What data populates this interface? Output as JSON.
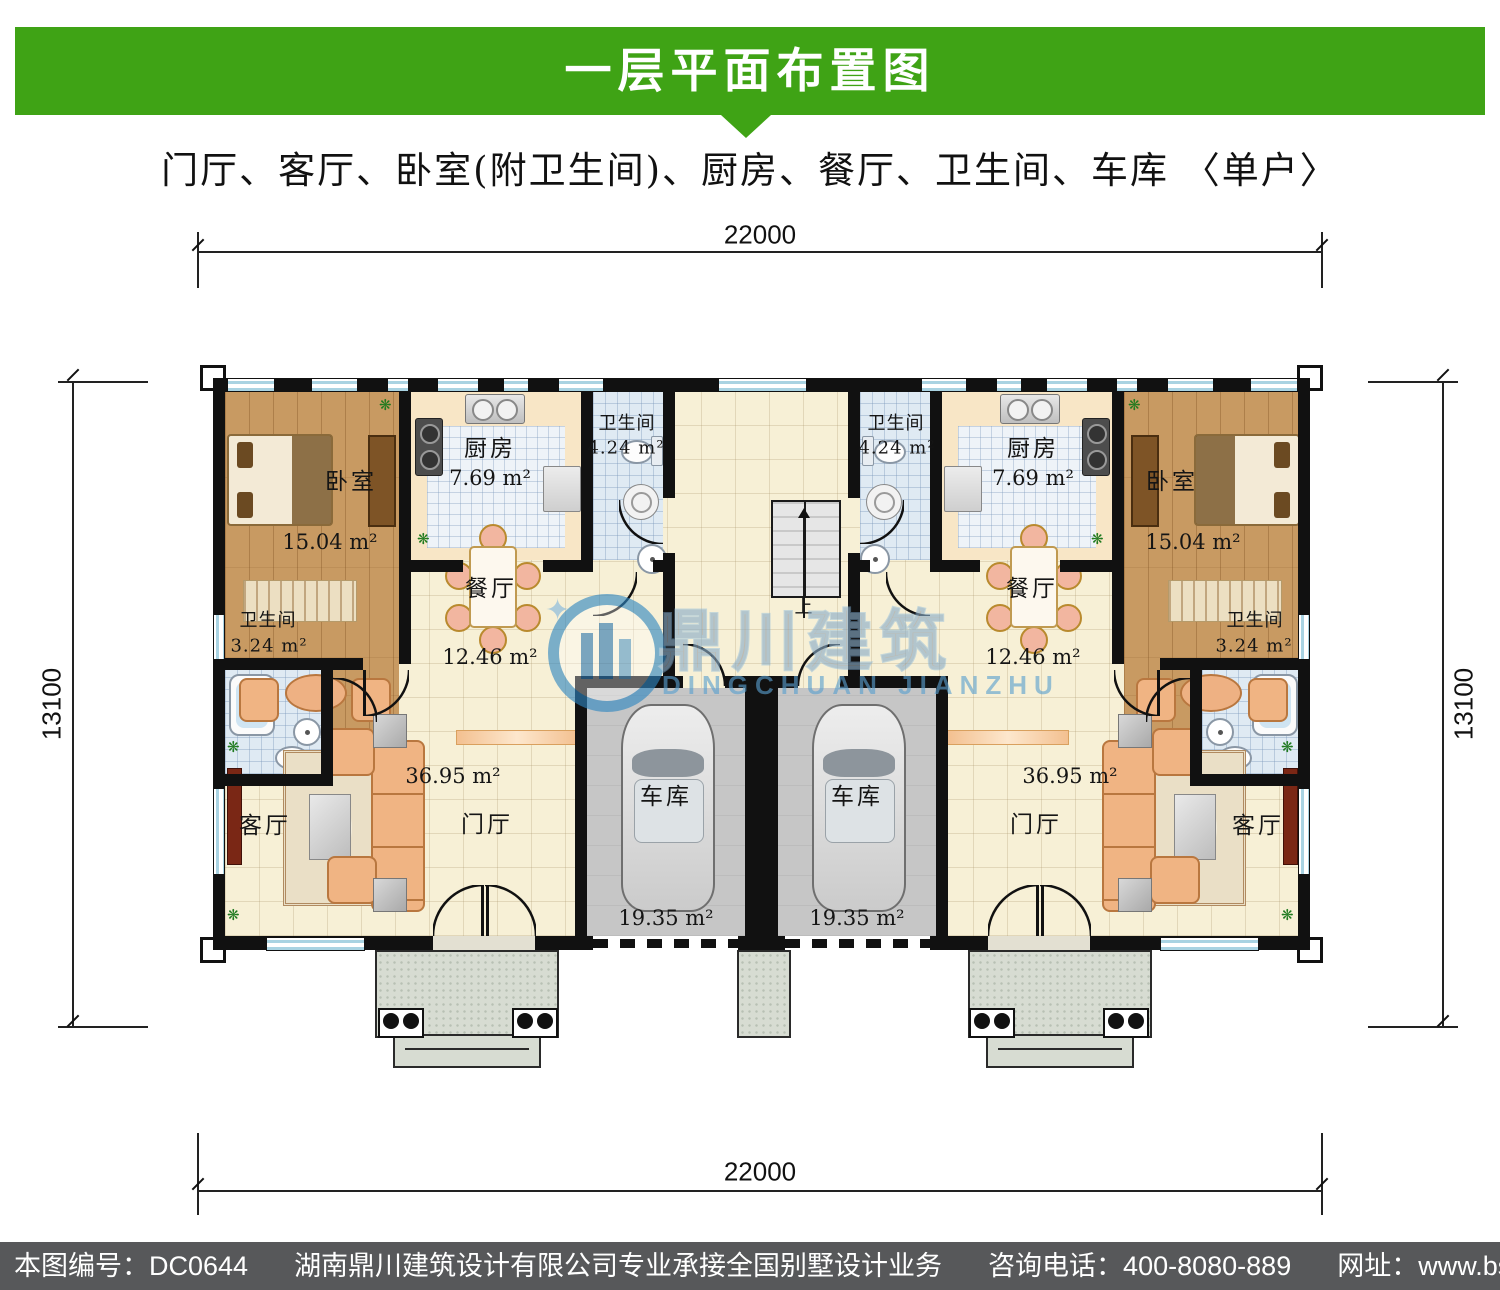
{
  "header": {
    "title": "一层平面布置图",
    "subtitle": "门厅、客厅、卧室(附卫生间)、厨房、餐厅、卫生间、车库 〈单户〉"
  },
  "dimensions": {
    "top": "22000",
    "bottom": "22000",
    "left": "13100",
    "right": "13100"
  },
  "rooms": {
    "bedroom": {
      "name": "卧室",
      "area": "15.04 m²"
    },
    "kitchen": {
      "name": "厨房",
      "area": "7.69 m²"
    },
    "bath_top": {
      "name": "卫生间",
      "area": "4.24 m²"
    },
    "bath_side": {
      "name": "卫生间",
      "area": "3.24 m²"
    },
    "dining": {
      "name": "餐厅",
      "area": "12.46 m²"
    },
    "living": {
      "name": "客厅"
    },
    "foyer": {
      "name": "门厅",
      "area": "36.95 m²"
    },
    "garage": {
      "name": "车库",
      "area": "19.35 m²"
    },
    "stairs": {
      "direction": "上"
    }
  },
  "watermark": {
    "cn": "鼎川建筑",
    "en": "DINGCHUAN JIANZHU",
    "spark": "✦"
  },
  "footer": {
    "drawing_no": "本图编号：DC0644",
    "company": "湖南鼎川建筑设计有限公司专业承接全国别墅设计业务",
    "phone": "咨询电话：400-8080-889",
    "website": "网址：www.bstzcs.com"
  },
  "colors": {
    "header_green": "#3fa315",
    "footer_gray": "#57585a",
    "wall_black": "#111111",
    "floor_cream": "#f7f0d6",
    "floor_wood": "#c89a62",
    "floor_tile_blue": "#dfeaf3",
    "garage_gray": "#c6c6c6",
    "watermark_blue": "#2e86c1"
  }
}
